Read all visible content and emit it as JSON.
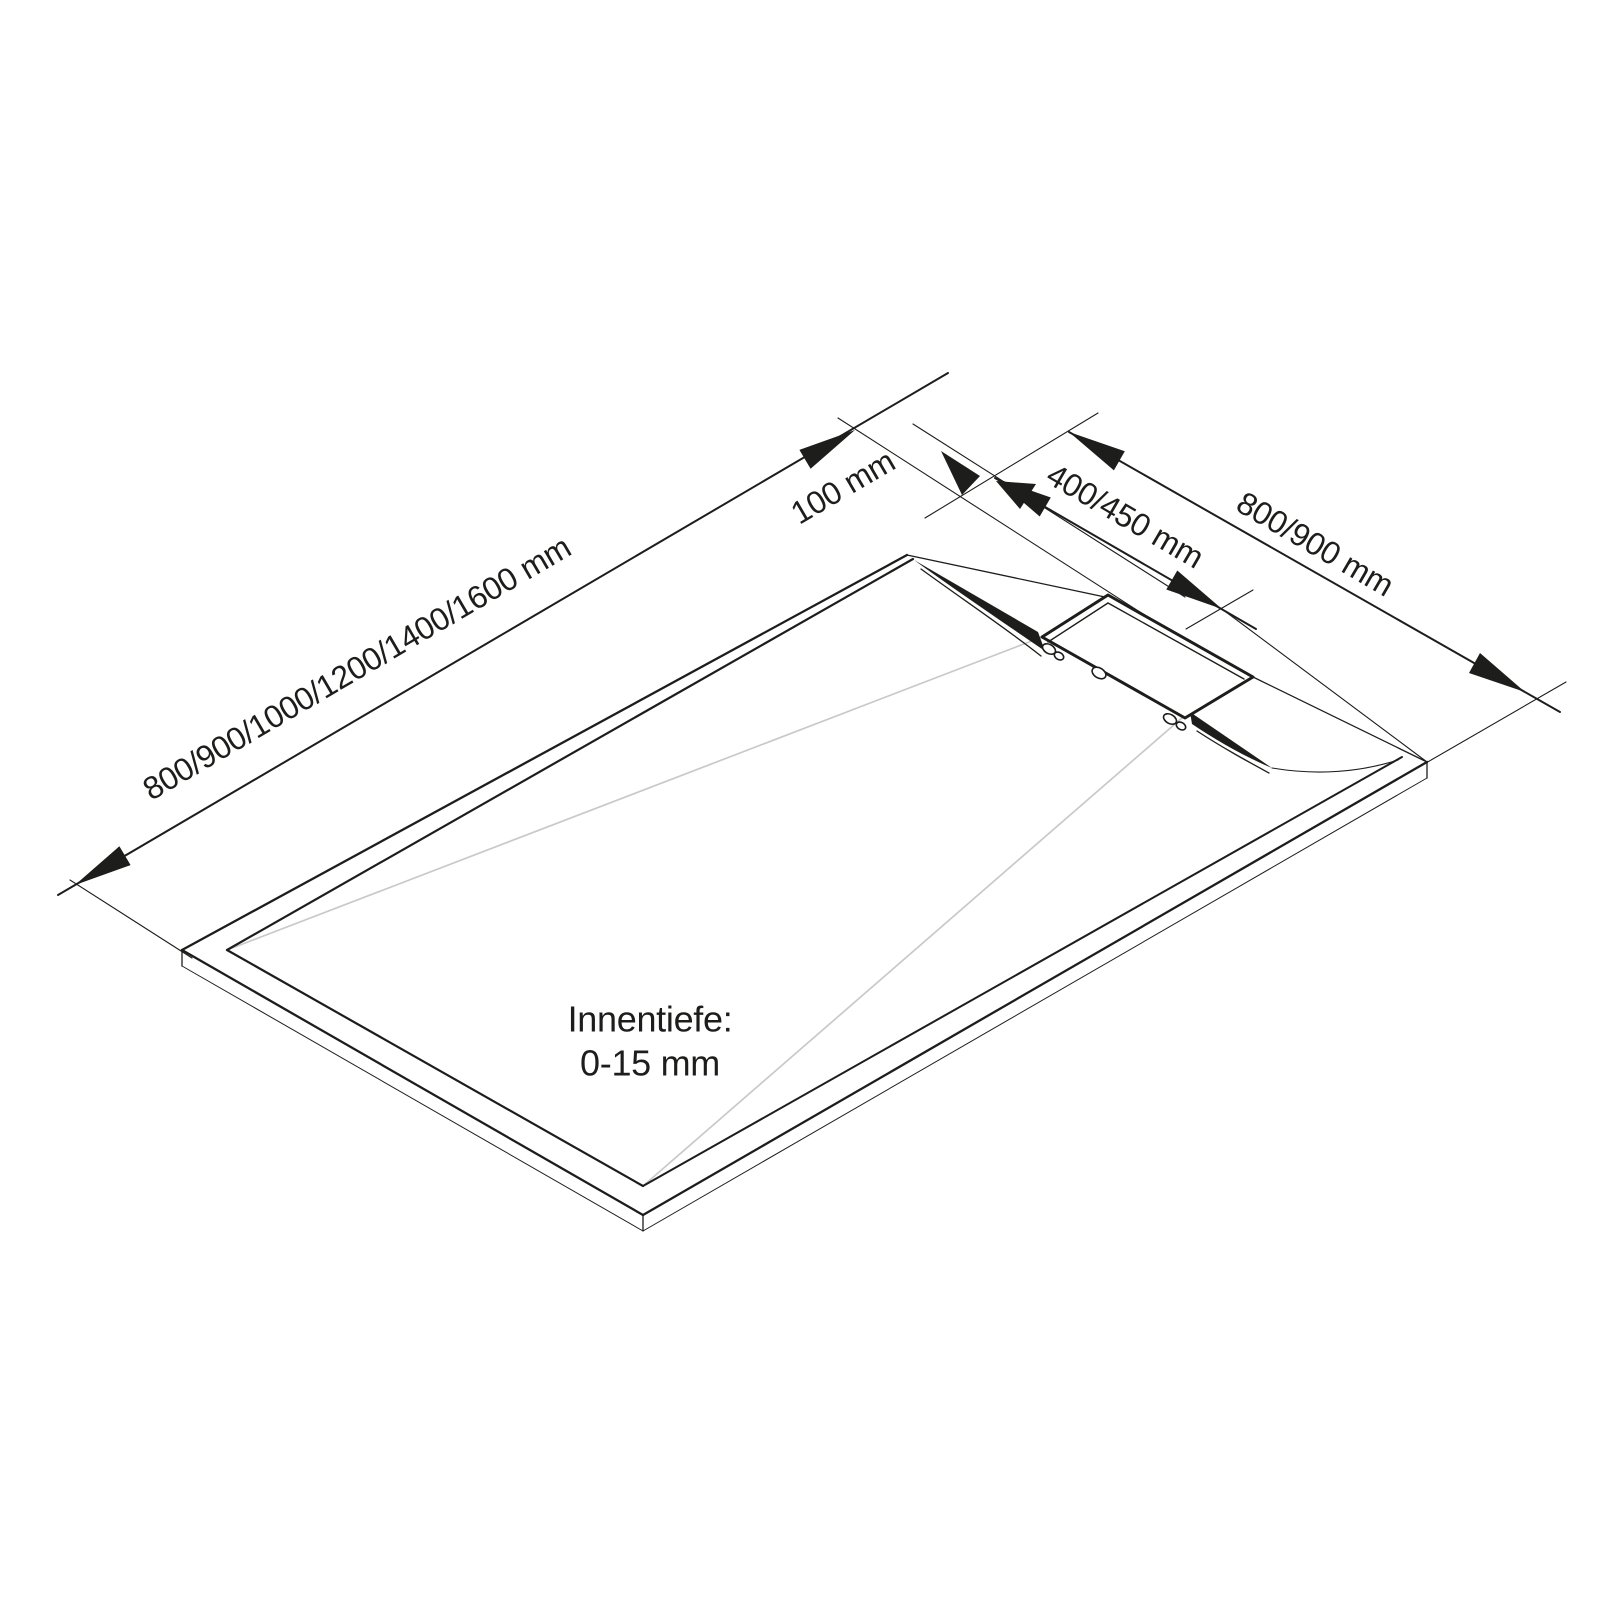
{
  "diagram": {
    "type": "technical-drawing",
    "subject": "shower-tray-with-linear-drain",
    "labels": {
      "length": "800/900/1000/1200/1400/1600 mm",
      "edge_offset": "100 mm",
      "drain_length": "400/450 mm",
      "width": "800/900 mm",
      "inner_depth_title": "Innentiefe:",
      "inner_depth_value": "0-15 mm"
    },
    "colors": {
      "line": "#1d1d1b",
      "slope-line": "#c9c9c9",
      "text": "#1d1d1b",
      "background": "#ffffff"
    }
  }
}
